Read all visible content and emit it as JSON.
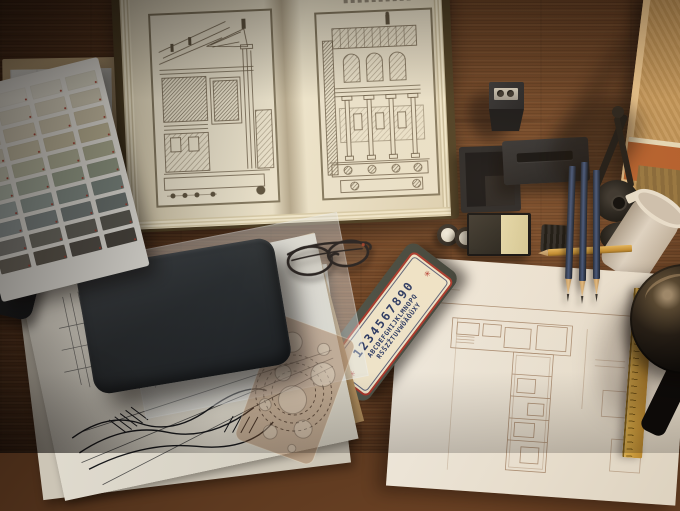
{
  "scene": {
    "description": "Top-down photograph of an architect's wooden desk with an open book of classical architecture engravings, paint swatch card, sketches, leather pouch, lettering guide, drafting tools and a floor-plan drawing",
    "desk_wood_color": "#5e3a20"
  },
  "lettering_guide": {
    "digits": "1234567890",
    "alphabet_line1": "ABCDEFGHIJKLMNOPQ",
    "alphabet_line2": "RSŠZŽTUVWÕÄÖÜXY",
    "star": "✳",
    "card_color": "#eee3c8",
    "border_color": "#a8382c",
    "text_color": "#2c3a63"
  },
  "swatch_card": {
    "rows": 10,
    "cols": 4,
    "colors": [
      [
        "#e8e6df",
        "#e6e3d8",
        "#e1ded1",
        "#dcd9c8"
      ],
      [
        "#e5e0d2",
        "#dfdac9",
        "#d9d3c0",
        "#d3cdb8"
      ],
      [
        "#e0d9c7",
        "#d8d0ba",
        "#d1c9b1",
        "#cbc2a8"
      ],
      [
        "#d8d3c0",
        "#cec7ad",
        "#c7bfa3",
        "#c0b899"
      ],
      [
        "#cccdb9",
        "#bfc0a7",
        "#b6b79d",
        "#adae93"
      ],
      [
        "#b8c1b2",
        "#a9b2a1",
        "#9da691",
        "#939c87"
      ],
      [
        "#a3aeaa",
        "#94a09a",
        "#88948d",
        "#7e8a83"
      ],
      [
        "#949d9c",
        "#848d8c",
        "#78817f",
        "#6e7774"
      ],
      [
        "#84837d",
        "#737269",
        "#67665e",
        "#5d5c54"
      ],
      [
        "#706b61",
        "#605b51",
        "#55514a",
        "#4b4740"
      ]
    ]
  },
  "palette": {
    "book_page": "#e9e1cb",
    "engraving_line": "#6e614c",
    "paper_white": "#ece7dd",
    "pencil_blue": "#2c3850",
    "ruler_yellow": "#c49a3c",
    "leather": "#2b2f32"
  }
}
